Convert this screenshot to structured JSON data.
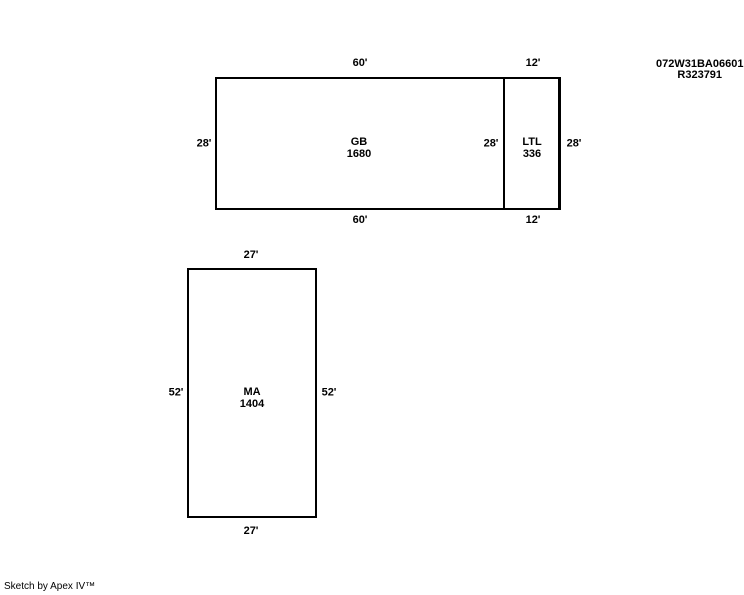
{
  "header": {
    "parcel_number": "072W31BA06601",
    "record_number": "R323791"
  },
  "areas": [
    {
      "code": "GB",
      "size": "1680",
      "dim_top": "60'",
      "dim_bottom": "60'",
      "dim_left": "28'",
      "dim_right": "28'"
    },
    {
      "code": "LTL",
      "size": "336",
      "dim_top": "12'",
      "dim_bottom": "12'",
      "dim_right": "28'"
    },
    {
      "code": "MA",
      "size": "1404",
      "dim_top": "27'",
      "dim_bottom": "27'",
      "dim_left": "52'",
      "dim_right": "52'"
    }
  ],
  "footer": {
    "text": "Sketch by Apex IV™"
  },
  "colors": {
    "background": "#ffffff",
    "line": "#000000",
    "text": "#000000"
  }
}
